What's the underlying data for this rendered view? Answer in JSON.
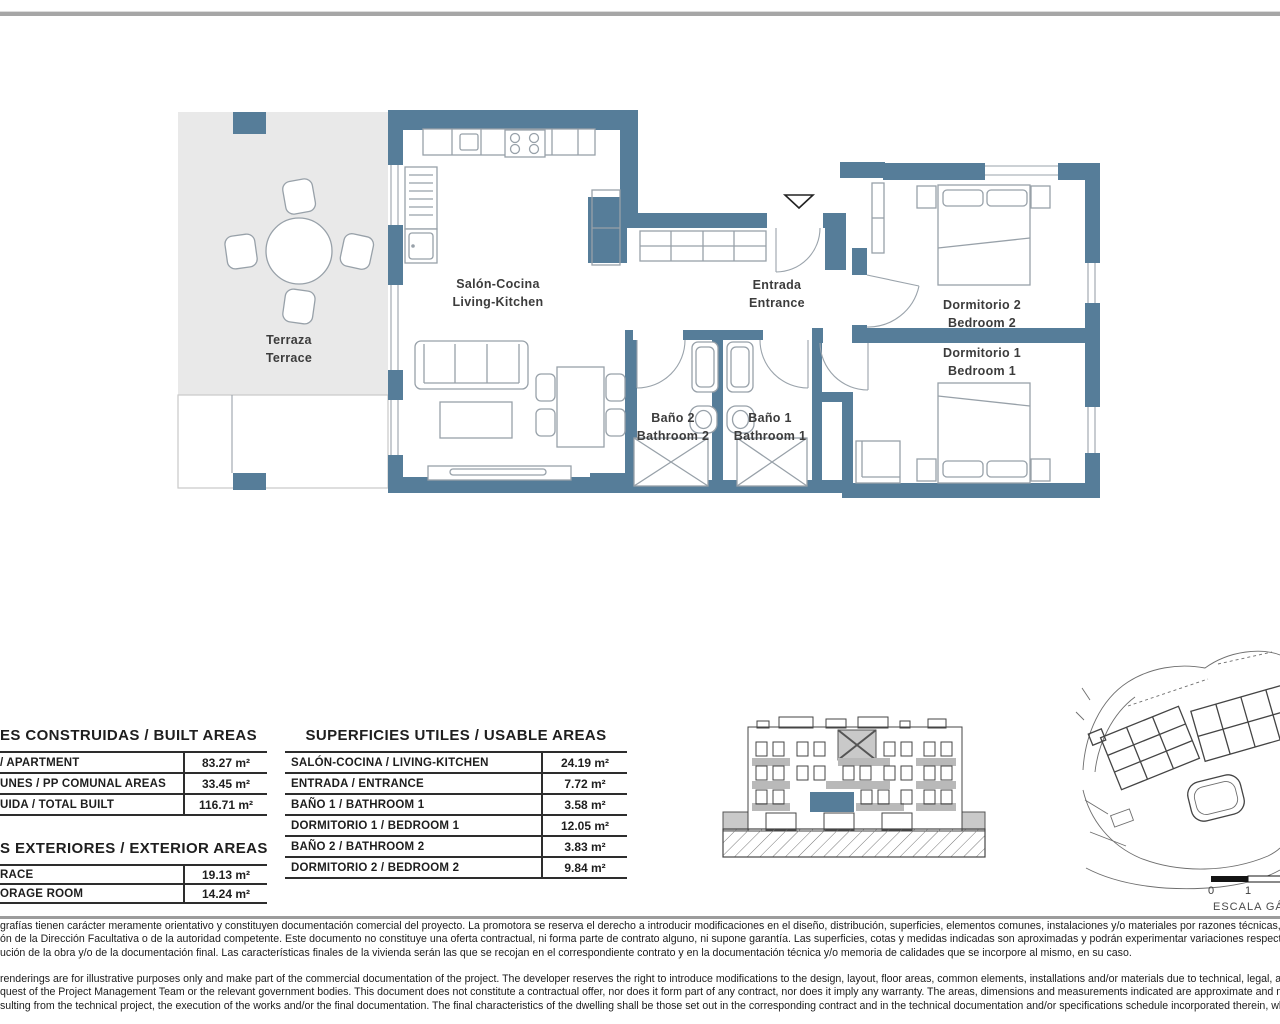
{
  "colors": {
    "wall": "#567d99",
    "terrace": "#e9e9e9",
    "rule": "#2d2d2d"
  },
  "plan": {
    "rooms": [
      {
        "name": "terraza",
        "line1": "Terraza",
        "line2": "Terrace"
      },
      {
        "name": "salon-cocina",
        "line1": "Salón-Cocina",
        "line2": "Living-Kitchen"
      },
      {
        "name": "entrada",
        "line1": "Entrada",
        "line2": "Entrance"
      },
      {
        "name": "bano2",
        "line1": "Baño 2",
        "line2": "Bathroom 2"
      },
      {
        "name": "bano1",
        "line1": "Baño 1",
        "line2": "Bathroom 1"
      },
      {
        "name": "dormitorio2",
        "line1": "Dormitorio 2",
        "line2": "Bedroom 2"
      },
      {
        "name": "dormitorio1",
        "line1": "Dormitorio 1",
        "line2": "Bedroom 1"
      }
    ]
  },
  "built_areas": {
    "title": "ES CONSTRUIDAS / BUILT AREAS",
    "rows": [
      {
        "label": "/ APARTMENT",
        "value": "83.27 m²"
      },
      {
        "label": "UNES / PP COMUNAL AREAS",
        "value": "33.45 m²"
      },
      {
        "label": "UIDA / TOTAL BUILT",
        "value": "116.71 m²"
      }
    ]
  },
  "exterior_areas": {
    "title": "S EXTERIORES / EXTERIOR AREAS",
    "rows": [
      {
        "label": "RACE",
        "value": "19.13 m²"
      },
      {
        "label": "ORAGE ROOM",
        "value": "14.24 m²"
      }
    ]
  },
  "usable_areas": {
    "title": "SUPERFICIES UTILES / USABLE AREAS",
    "rows": [
      {
        "label": "SALÓN-COCINA / LIVING-KITCHEN",
        "value": "24.19 m²"
      },
      {
        "label": "ENTRADA / ENTRANCE",
        "value": "7.72 m²"
      },
      {
        "label": "BAÑO 1 / BATHROOM 1",
        "value": "3.58 m²"
      },
      {
        "label": "DORMITORIO 1 / BEDROOM 1",
        "value": "12.05 m²"
      },
      {
        "label": "BAÑO 2 / BATHROOM 2",
        "value": "3.83 m²"
      },
      {
        "label": "DORMITORIO 2 / BEDROOM 2",
        "value": "9.84 m²"
      }
    ]
  },
  "scale_bar": {
    "tick_0": "0",
    "tick_1": "1",
    "caption": "ESCALA GÁFICA"
  },
  "disclaimer_es": {
    "line1": "grafías tienen carácter meramente orientativo y constituyen documentación comercial del proyecto. La promotora se reserva el derecho a introducir modificaciones en el diseño, distribución, superficies, elementos comunes, instalaciones y/o materiales por razones técnicas, legales o administrativas",
    "line2": "ón de la Dirección Facultativa o de la autoridad competente. Este documento no constituye una oferta contractual, ni forma parte de contrato alguno, ni supone garantía. Las superficies, cotas y medidas indicadas son aproximadas y podrán experimentar variaciones respecto de las definitivas",
    "line3": "ución de la obra y/o de la documentación final. Las características finales de la vivienda serán las que se recojan en el correspondiente contrato y en la documentación técnica y/o memoria de calidades que se incorpore al mismo, en su caso."
  },
  "disclaimer_en": {
    "line1": "renderings are for illustrative purposes only and make part of the commercial documentation of the project. The developer reserves the right to introduce modifications to the design, layout, floor areas, common elements, installations and/or materials due to technical, legal, administrative",
    "line2": "quest of the Project Management Team or the relevant government bodies. This document does not constitute a contractual offer, nor does it form part of any contract, nor does it imply any warranty. The areas, dimensions and measurements indicated are approximate and may be subject",
    "line3": "sulting from the technical project, the execution of the works and/or the final documentation. The final characteristics of the dwelling shall be those set out in the corresponding contract and in the technical documentation and/or specifications schedule incorporated therein, where applicable."
  }
}
